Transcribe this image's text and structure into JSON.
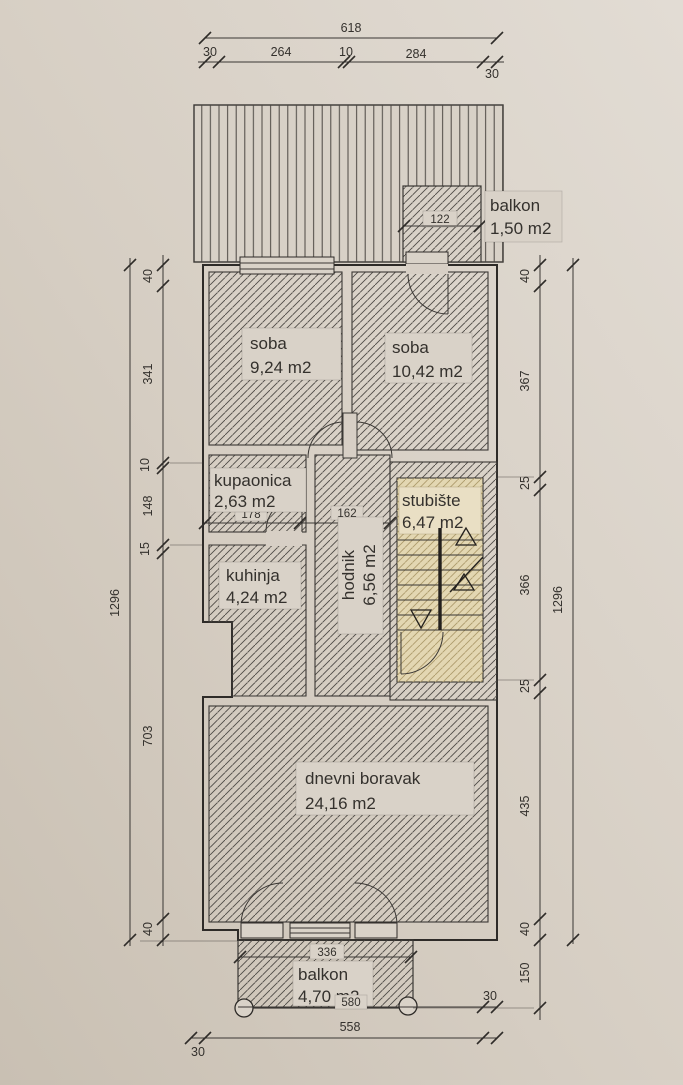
{
  "drawing": {
    "type": "architectural floor plan",
    "rooms": [
      {
        "id": "balkon-top",
        "name": "balkon",
        "area": "1,50 m2"
      },
      {
        "id": "soba-1",
        "name": "soba",
        "area": "9,24 m2"
      },
      {
        "id": "soba-2",
        "name": "soba",
        "area": "10,42 m2"
      },
      {
        "id": "kupaonica",
        "name": "kupaonica",
        "area": "2,63 m2"
      },
      {
        "id": "kuhinja",
        "name": "kuhinja",
        "area": "4,24 m2"
      },
      {
        "id": "hodnik",
        "name": "hodnik",
        "area": "6,56 m2"
      },
      {
        "id": "stubiste",
        "name": "stubište",
        "area": "6,47 m2"
      },
      {
        "id": "dnevni-boravak",
        "name": "dnevni boravak",
        "area": "24,16 m2"
      },
      {
        "id": "balkon-bottom",
        "name": "balkon",
        "area": "4,70 m2"
      }
    ],
    "dims": {
      "top": {
        "total": "618",
        "segments": [
          "30",
          "264",
          "10",
          "284",
          "30"
        ]
      },
      "left": {
        "overall": "1296",
        "segments": [
          "40",
          "341",
          "10",
          "148",
          "15",
          "703",
          "40"
        ]
      },
      "right": {
        "overall": "1296",
        "segments": [
          "40",
          "367",
          "25",
          "366",
          "25",
          "435",
          "40",
          "150"
        ]
      },
      "bottom": {
        "width": "558",
        "margin_left": "30",
        "margin_right": "30",
        "balkon_width": "580",
        "balkon_opening": "336"
      },
      "interior": {
        "balkon_top_width": "122",
        "kupaonica_width": "178",
        "hodnik_width": "162"
      }
    },
    "colors": {
      "paper": "#d7cfc5",
      "ink": "#3a3734",
      "stair_fill": "#e3d7b2"
    }
  }
}
